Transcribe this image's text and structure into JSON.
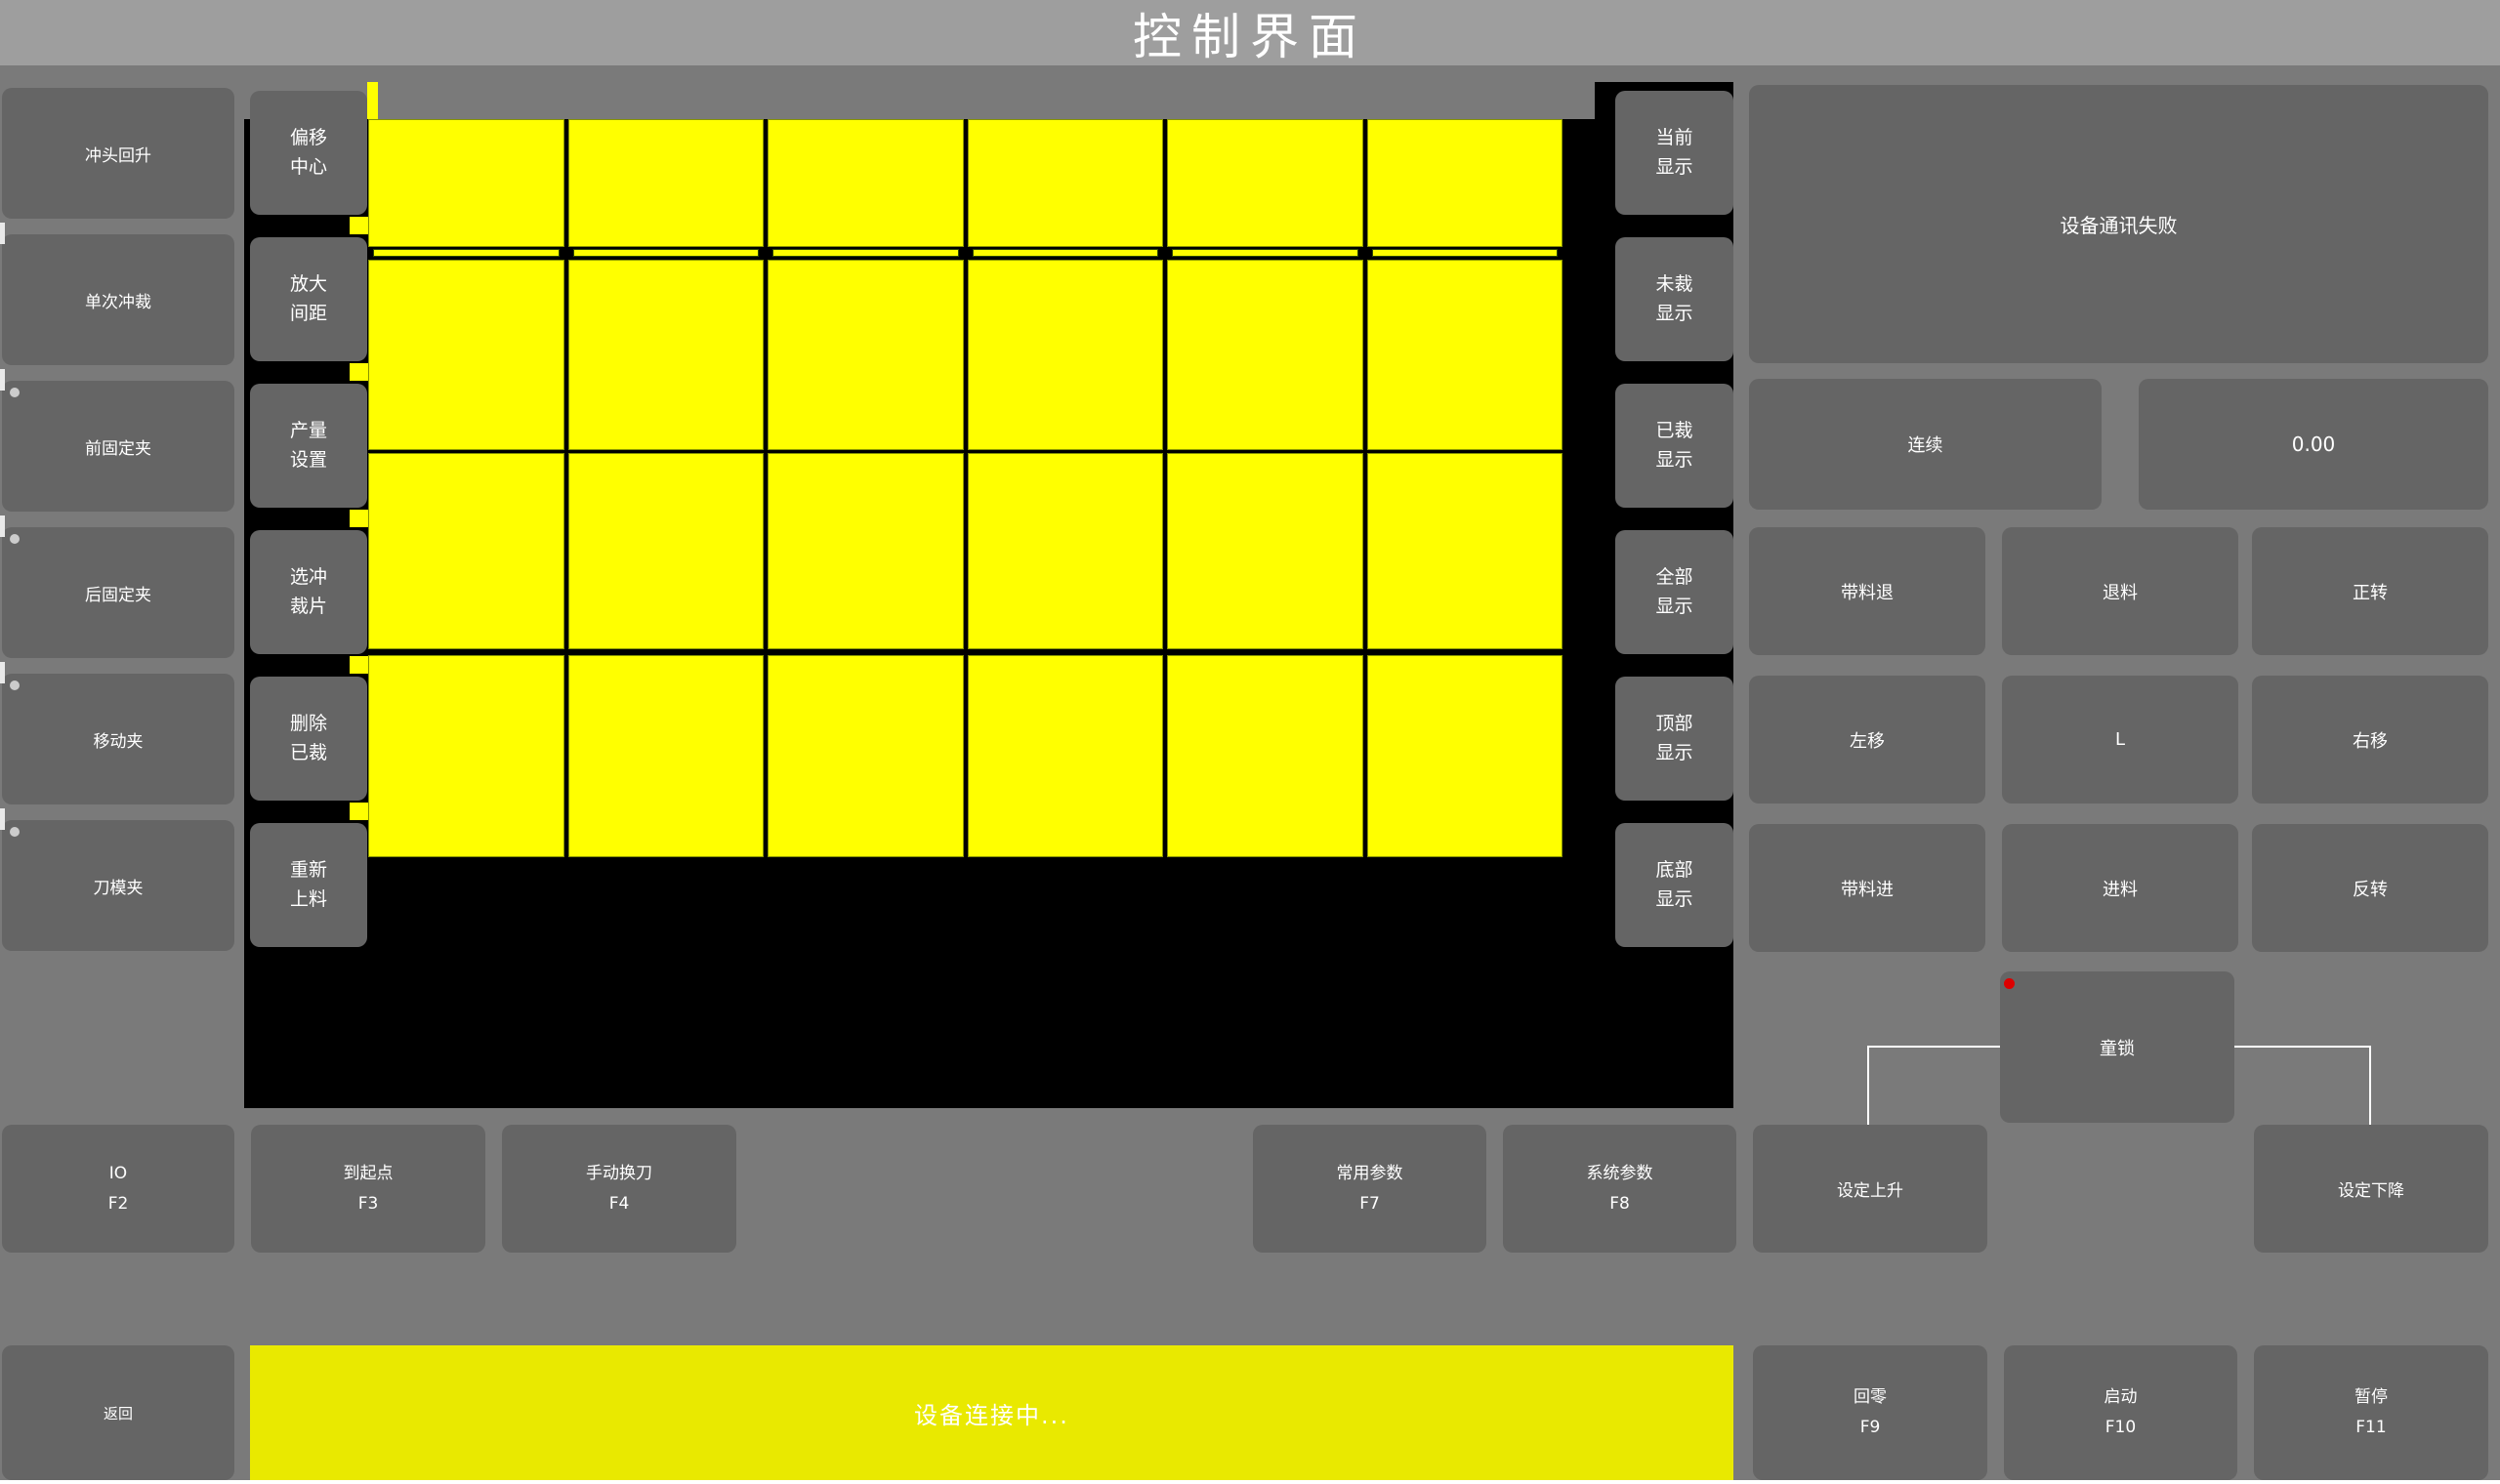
{
  "title": "控制界面",
  "colors": {
    "background": "#7a7a7a",
    "titlebar": "#9e9e9e",
    "button": "#656565",
    "canvas_black": "#000000",
    "piece_yellow": "#ffff00",
    "statusbar_yellow": "#e9e900",
    "alert_red": "#dd0000",
    "indicator_gray": "#cccccc"
  },
  "left_column": [
    {
      "label": "冲头回升",
      "dot": false
    },
    {
      "label": "单次冲裁",
      "dot": false
    },
    {
      "label": "前固定夹",
      "dot": true
    },
    {
      "label": "后固定夹",
      "dot": true
    },
    {
      "label": "移动夹",
      "dot": true
    },
    {
      "label": "刀模夹",
      "dot": true
    }
  ],
  "tool_column": [
    {
      "line1": "偏移",
      "line2": "中心"
    },
    {
      "line1": "放大",
      "line2": "间距"
    },
    {
      "line1": "产量",
      "line2": "设置"
    },
    {
      "line1": "选冲",
      "line2": "裁片"
    },
    {
      "line1": "删除",
      "line2": "已裁"
    },
    {
      "line1": "重新",
      "line2": "上料"
    }
  ],
  "view_column": [
    {
      "line1": "当前",
      "line2": "显示"
    },
    {
      "line1": "未裁",
      "line2": "显示"
    },
    {
      "line1": "已裁",
      "line2": "显示"
    },
    {
      "line1": "全部",
      "line2": "显示"
    },
    {
      "line1": "顶部",
      "line2": "显示"
    },
    {
      "line1": "底部",
      "line2": "显示"
    }
  ],
  "canvas": {
    "nest_grid": {
      "columns": 6,
      "piece_rows": 4,
      "strip_rows": 1,
      "piece_color": "#ffff00"
    }
  },
  "right_panel": {
    "status_message": "设备通讯失败",
    "mode_button": "连续",
    "value_display": "0.00",
    "jog_buttons": [
      "带料退",
      "退料",
      "正转",
      "左移",
      "L",
      "右移",
      "带料进",
      "进料",
      "反转"
    ],
    "child_lock": "童锁"
  },
  "function_row": [
    {
      "label": "IO",
      "fkey": "F2"
    },
    {
      "label": "到起点",
      "fkey": "F3"
    },
    {
      "label": "手动换刀",
      "fkey": "F4"
    },
    {
      "label": "常用参数",
      "fkey": "F7"
    },
    {
      "label": "系统参数",
      "fkey": "F8"
    },
    {
      "label": "设定上升",
      "fkey": ""
    },
    {
      "label": "设定下降",
      "fkey": ""
    }
  ],
  "bottom_bar": {
    "back": "返回",
    "connection_message": "设备连接中...",
    "buttons": [
      {
        "label": "回零",
        "fkey": "F9"
      },
      {
        "label": "启动",
        "fkey": "F10"
      },
      {
        "label": "暂停",
        "fkey": "F11"
      }
    ]
  }
}
